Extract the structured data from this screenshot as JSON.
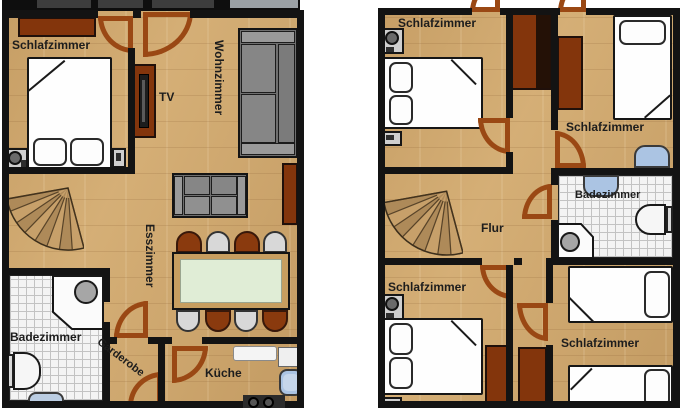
{
  "left_plan": {
    "labels": {
      "schlafzimmer": "Schlafzimmer",
      "wohnzimmer": "Wohnzimmer",
      "tv": "TV",
      "esszimmer": "Esszimmer",
      "badezimmer": "Badezimmer",
      "garderobe": "Garderobe",
      "kueche": "Küche"
    }
  },
  "right_plan": {
    "labels": {
      "schlafzimmer_nw": "Schlafzimmer",
      "schlafzimmer_ne": "Schlafzimmer",
      "badezimmer": "Badezimmer",
      "flur": "Flur",
      "schlafzimmer_sw": "Schlafzimmer",
      "schlafzimmer_se": "Schlafzimmer"
    }
  },
  "colors": {
    "wall": "#131313",
    "wood_floor": "#CFA76C",
    "furniture_brown": "#83350C",
    "door_swing": "#9A4814",
    "sofa_gray": "#6F6F6F",
    "table_green": "#E0EDD6",
    "sink_blue": "#ABC4E3",
    "tile_floor": "#F4F4F4",
    "terrace_dark": "#3D3D3D"
  }
}
